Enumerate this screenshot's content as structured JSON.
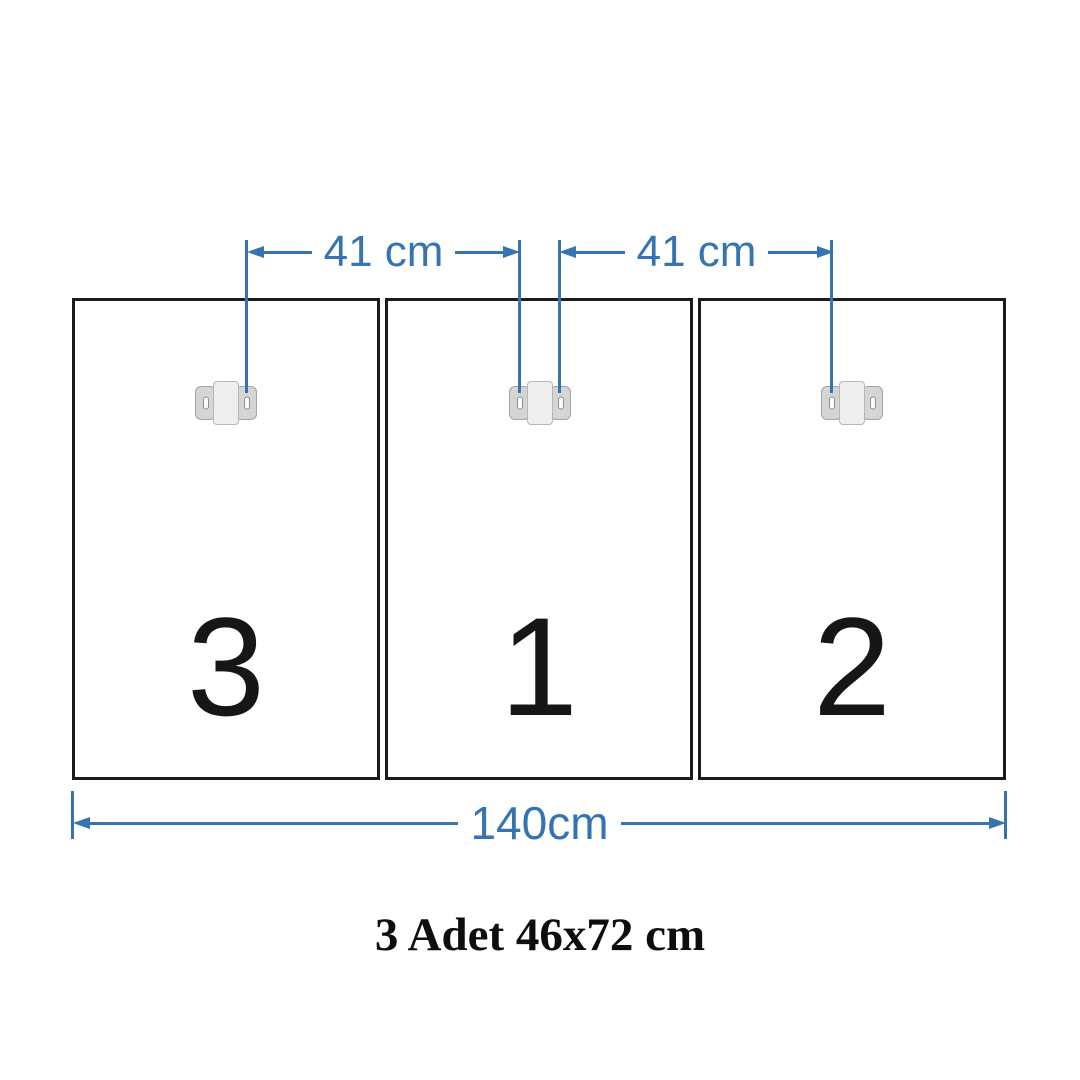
{
  "diagram": {
    "title": "triptych panel mounting diagram",
    "colors": {
      "accent_blue": "#3673b1",
      "panel_border": "#1c1c1c",
      "background": "#ffffff",
      "bracket_gray": "#d5d5d5"
    },
    "panels": [
      {
        "label": "3"
      },
      {
        "label": "1"
      },
      {
        "label": "2"
      }
    ],
    "bracket_icon": "wall-mount-bracket",
    "dimensions": {
      "gap_left": "41 cm",
      "gap_right": "41 cm",
      "total_width": "140cm"
    },
    "caption": "3 Adet 46x72 cm"
  }
}
